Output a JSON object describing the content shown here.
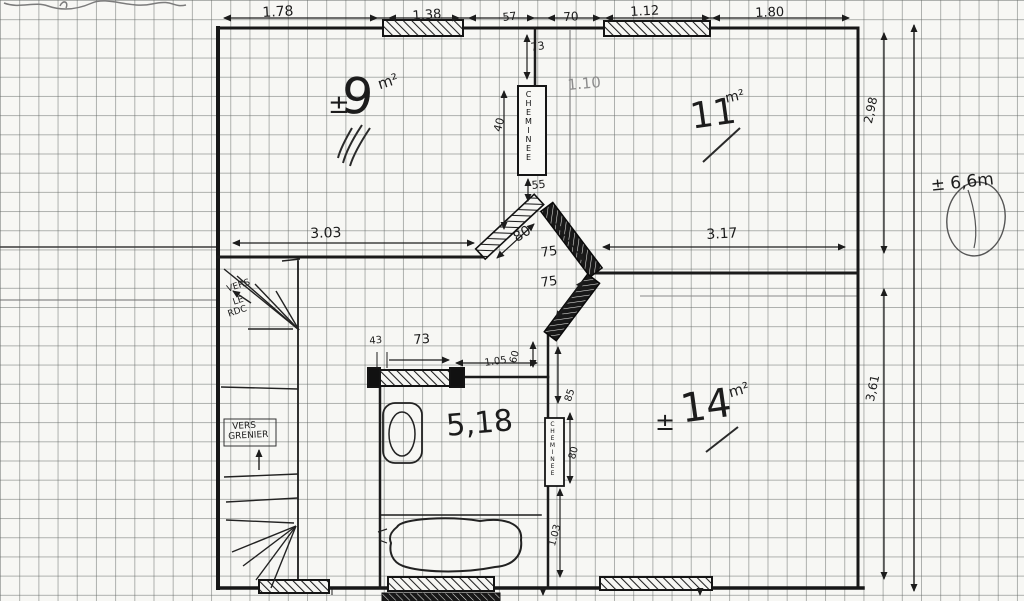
{
  "document": {
    "kind": "hand-drawn floor plan sketch on graph paper",
    "ink_color": "#1c1c1c",
    "paper_color": "#f7f7f4",
    "grid_color": "#646966"
  },
  "rooms": {
    "room_9": {
      "sign": "±",
      "value": "9",
      "unit": "m²"
    },
    "room_11": {
      "value": "11",
      "unit": "m²"
    },
    "room_bath": {
      "value": "5,18"
    },
    "room_14": {
      "sign": "±",
      "value": "14",
      "unit": "m²"
    }
  },
  "annotations": {
    "chimney_upper": "CHEMINEE",
    "chimney_lower": "CHEMINEE",
    "stairs_down": "VERS LE RDC",
    "stairs_up": "VERS GRENIER",
    "total_height": "± 6,6m"
  },
  "labels": [
    {
      "id": "dim-top-178",
      "t": "1.78",
      "x": 262,
      "y": 6,
      "r": -3,
      "s": 14
    },
    {
      "id": "dim-top-138",
      "t": "1.38",
      "x": 412,
      "y": 10,
      "r": -4,
      "s": 13
    },
    {
      "id": "dim-top-57",
      "t": "57",
      "x": 502,
      "y": 12,
      "r": -6,
      "s": 11
    },
    {
      "id": "dim-top-70",
      "t": "70",
      "x": 563,
      "y": 11,
      "r": -3,
      "s": 12
    },
    {
      "id": "dim-top-112",
      "t": "1.12",
      "x": 630,
      "y": 6,
      "r": -3,
      "s": 13
    },
    {
      "id": "dim-top-180",
      "t": "1.80",
      "x": 755,
      "y": 7,
      "r": -2,
      "s": 13
    },
    {
      "id": "dim-right-298",
      "t": "2,98",
      "x": 862,
      "y": 122,
      "r": -78,
      "s": 12
    },
    {
      "id": "dim-right-361",
      "t": "3,61",
      "x": 864,
      "y": 400,
      "r": -78,
      "s": 12
    },
    {
      "id": "dim-total-66",
      "t": "± 6,6m",
      "x": 930,
      "y": 178,
      "r": -6,
      "s": 17
    },
    {
      "id": "note-110",
      "t": "1.10",
      "x": 567,
      "y": 78,
      "r": -5,
      "s": 15,
      "c": "faint"
    },
    {
      "id": "room9-pm",
      "t": "±",
      "x": 328,
      "y": 92,
      "r": 0,
      "s": 26
    },
    {
      "id": "room9-value",
      "t": "9",
      "x": 344,
      "y": 70,
      "r": 6,
      "s": 50
    },
    {
      "id": "room9-unit",
      "t": "m²",
      "x": 376,
      "y": 78,
      "r": -18,
      "s": 15
    },
    {
      "id": "room11-value",
      "t": "11",
      "x": 688,
      "y": 100,
      "r": -8,
      "s": 36
    },
    {
      "id": "room11-unit",
      "t": "m²",
      "x": 724,
      "y": 92,
      "r": -12,
      "s": 14
    },
    {
      "id": "chimney-upper-label",
      "t": "CHEMINEE",
      "x": 524,
      "y": 90,
      "r": 0,
      "s": 8,
      "c": "vtext"
    },
    {
      "id": "dim-73",
      "t": "73",
      "x": 530,
      "y": 42,
      "r": -8,
      "s": 11
    },
    {
      "id": "dim-40",
      "t": "40",
      "x": 492,
      "y": 130,
      "r": -75,
      "s": 11
    },
    {
      "id": "dim-55",
      "t": "55",
      "x": 531,
      "y": 180,
      "r": -6,
      "s": 11
    },
    {
      "id": "dim-303",
      "t": "3.03",
      "x": 310,
      "y": 227,
      "r": -2,
      "s": 14
    },
    {
      "id": "dim-80-door",
      "t": "80",
      "x": 511,
      "y": 233,
      "r": -32,
      "s": 14
    },
    {
      "id": "dim-75a",
      "t": "75",
      "x": 540,
      "y": 247,
      "r": -8,
      "s": 13
    },
    {
      "id": "dim-75b",
      "t": "75",
      "x": 540,
      "y": 277,
      "r": -8,
      "s": 13
    },
    {
      "id": "dim-317",
      "t": "3.17",
      "x": 706,
      "y": 228,
      "r": -3,
      "s": 14
    },
    {
      "id": "dim-bath-43",
      "t": "43",
      "x": 369,
      "y": 337,
      "r": -5,
      "s": 10
    },
    {
      "id": "dim-bath-73",
      "t": "73",
      "x": 413,
      "y": 334,
      "r": -4,
      "s": 13
    },
    {
      "id": "dim-bath-105",
      "t": "1.05",
      "x": 484,
      "y": 359,
      "r": -8,
      "s": 10
    },
    {
      "id": "dim-bath-60",
      "t": "60",
      "x": 509,
      "y": 362,
      "r": -75,
      "s": 10
    },
    {
      "id": "dim-85",
      "t": "85",
      "x": 564,
      "y": 400,
      "r": -72,
      "s": 10
    },
    {
      "id": "dim-80b",
      "t": "80",
      "x": 568,
      "y": 458,
      "r": -75,
      "s": 10
    },
    {
      "id": "dim-103",
      "t": "1.03",
      "x": 548,
      "y": 545,
      "r": -75,
      "s": 10
    },
    {
      "id": "chimney-lower-label",
      "t": "CHEMINEE",
      "x": 549,
      "y": 421,
      "r": 0,
      "s": 6,
      "c": "vtext"
    },
    {
      "id": "roombath-value",
      "t": "5,18",
      "x": 445,
      "y": 412,
      "r": -5,
      "s": 30
    },
    {
      "id": "room14-pm",
      "t": "±",
      "x": 655,
      "y": 410,
      "r": 0,
      "s": 24
    },
    {
      "id": "room14-value",
      "t": "14",
      "x": 678,
      "y": 390,
      "r": -8,
      "s": 40
    },
    {
      "id": "room14-unit",
      "t": "m²",
      "x": 727,
      "y": 386,
      "r": -16,
      "s": 15
    },
    {
      "id": "stairs-down-line1",
      "t": "VERS",
      "x": 226,
      "y": 286,
      "r": -18,
      "s": 9
    },
    {
      "id": "stairs-down-line2",
      "t": "LE",
      "x": 232,
      "y": 299,
      "r": -18,
      "s": 9
    },
    {
      "id": "stairs-down-line3",
      "t": "RDC",
      "x": 227,
      "y": 311,
      "r": -18,
      "s": 9
    },
    {
      "id": "stairs-up-line1",
      "t": "VERS",
      "x": 232,
      "y": 423,
      "r": -3,
      "s": 9
    },
    {
      "id": "stairs-up-line2",
      "t": "GRENIER",
      "x": 228,
      "y": 433,
      "r": -3,
      "s": 9
    }
  ]
}
